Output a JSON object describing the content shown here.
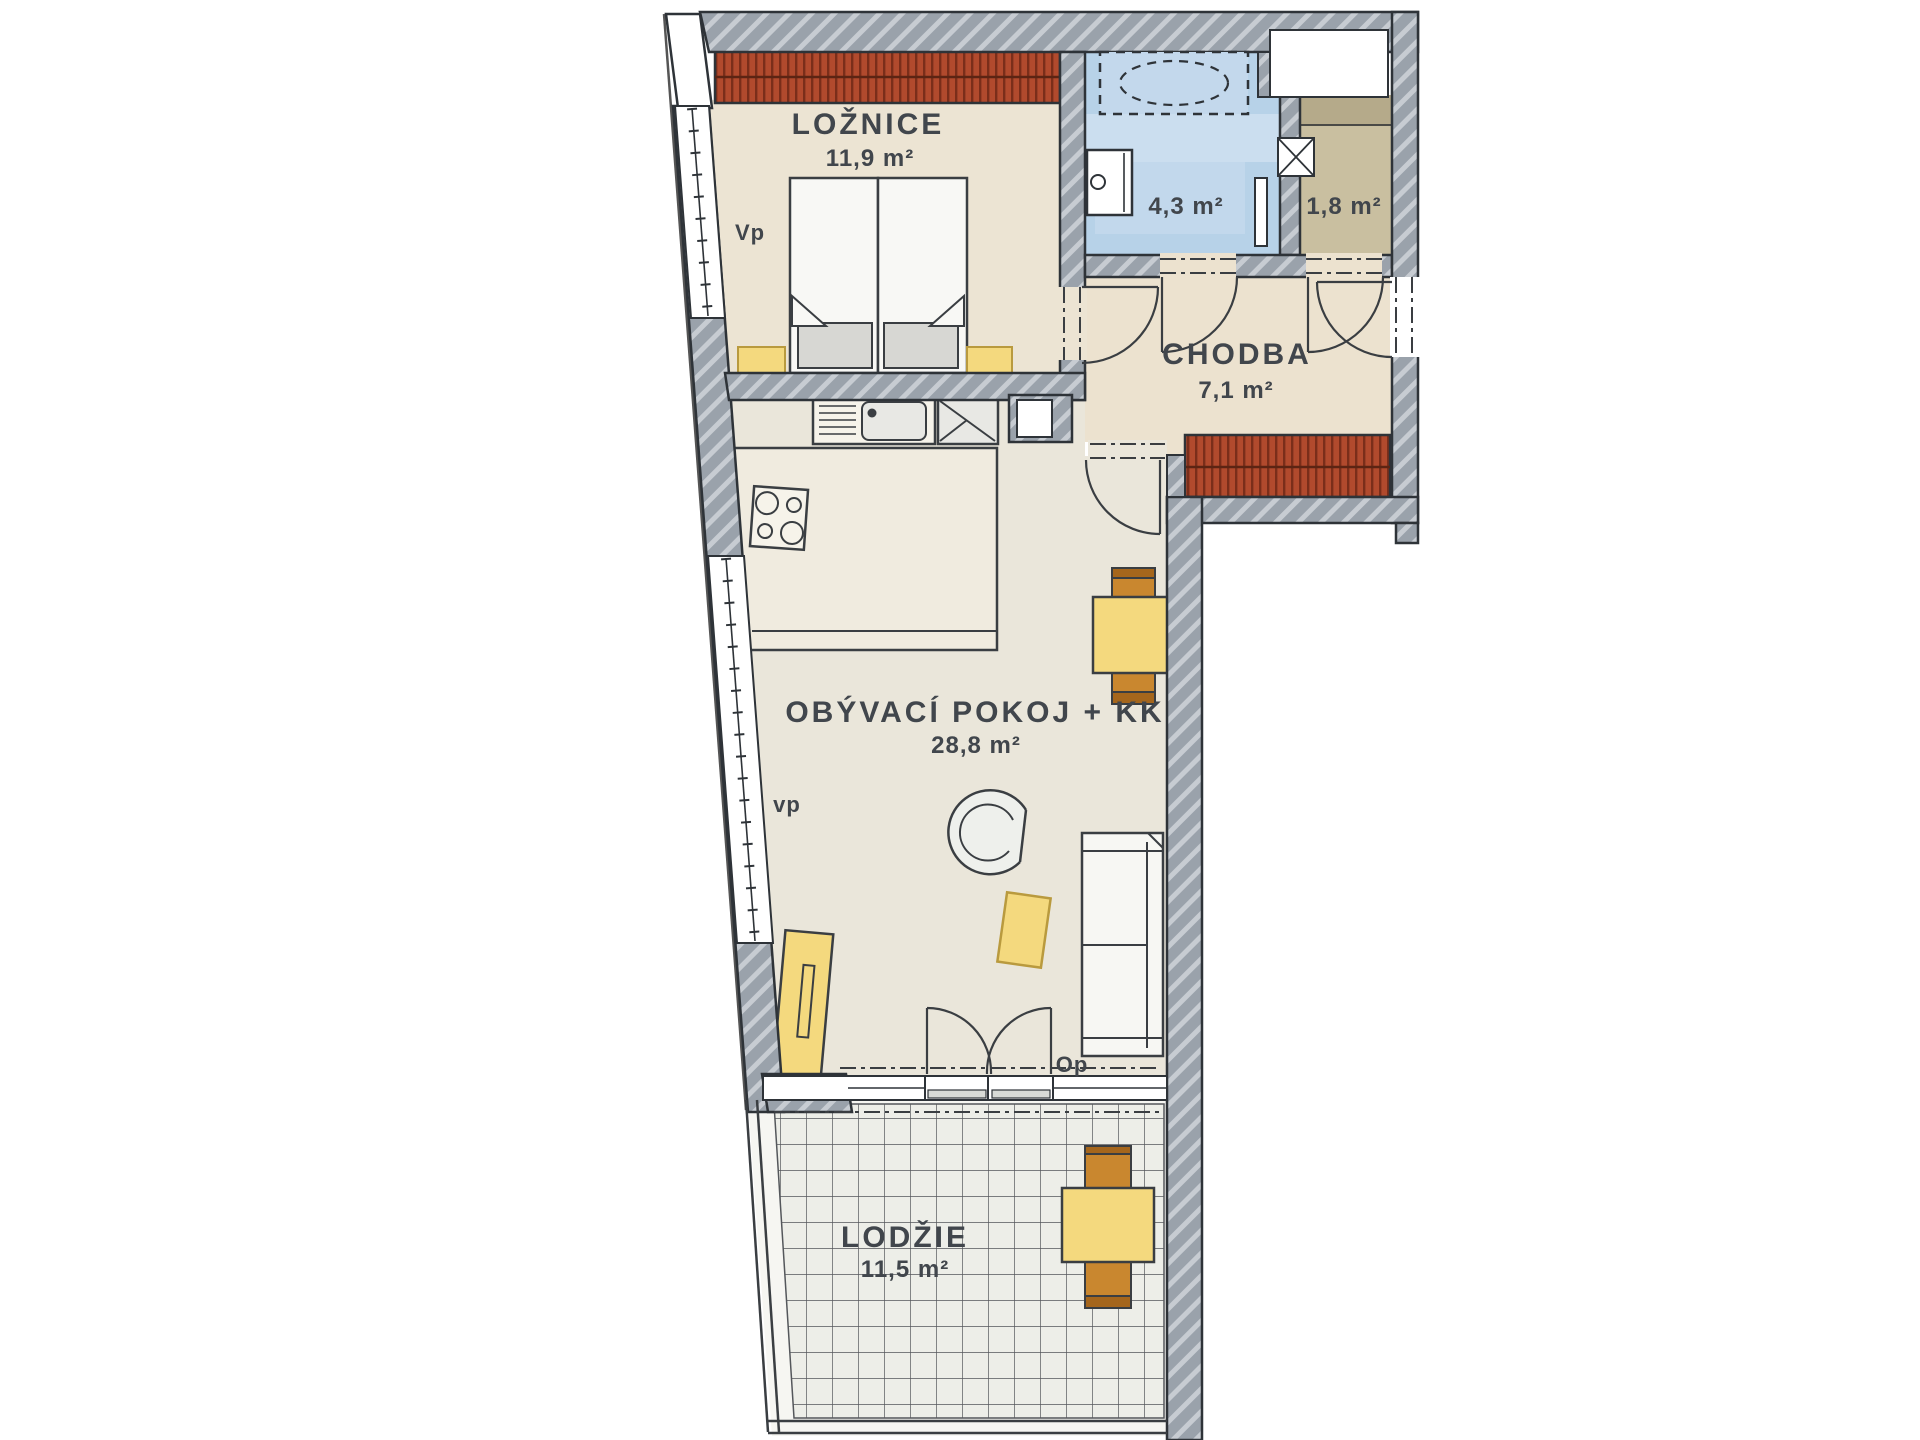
{
  "plan": {
    "title": "Apartment floor plan (2+kk with loggia)",
    "rooms": [
      {
        "id": "loznice",
        "name": "LOŽNICE",
        "area": "11,9 m²"
      },
      {
        "id": "koupelna",
        "name": "",
        "area": "4,3 m²"
      },
      {
        "id": "komora",
        "name": "",
        "area": "1,8 m²"
      },
      {
        "id": "chodba",
        "name": "CHODBA",
        "area": "7,1 m²"
      },
      {
        "id": "obyvaci",
        "name": "OBÝVACÍ POKOJ + KK",
        "area": "28,8 m²"
      },
      {
        "id": "lodzie",
        "name": "LODŽIE",
        "area": "11,5 m²"
      }
    ],
    "codes": {
      "bedroom_window": "Vp",
      "living_window": "vp",
      "balcony_door": "Op"
    },
    "colors": {
      "wall_gray": "#9aa2ab",
      "wall_hatch": "#c7ccd2",
      "outline": "#2e3338",
      "floor_cream": "#ece4d3",
      "floor_living": "#eae6da",
      "bathroom_blue": "#b7d2e8",
      "komora_tan": "#c9bfa0",
      "wardrobe_red": "#b14a2d",
      "furniture_yellow": "#f4d97e",
      "chair_orange": "#c9872f",
      "tile_floor": "#edeee8"
    }
  }
}
